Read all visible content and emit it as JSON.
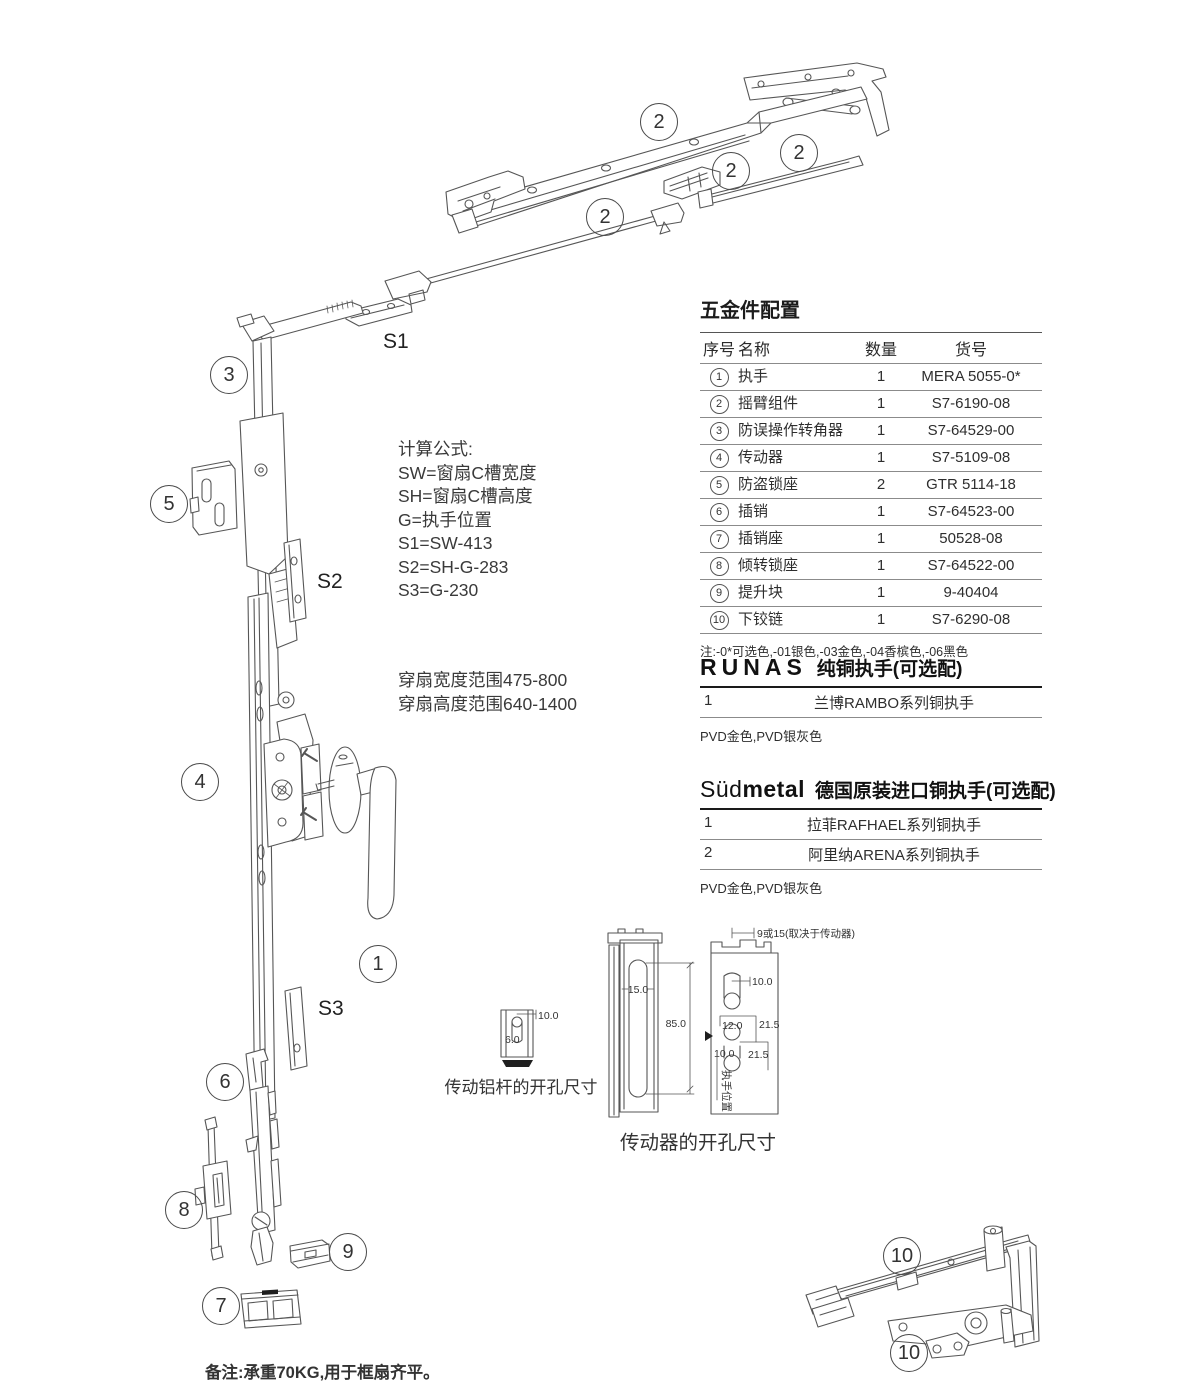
{
  "callouts": [
    {
      "x": 658,
      "y": 121,
      "label": "2"
    },
    {
      "x": 730,
      "y": 170,
      "label": "2"
    },
    {
      "x": 798,
      "y": 152,
      "label": "2"
    },
    {
      "x": 604,
      "y": 216,
      "label": "2"
    },
    {
      "x": 228,
      "y": 374,
      "label": "3"
    },
    {
      "x": 168,
      "y": 503,
      "label": "5"
    },
    {
      "x": 199,
      "y": 781,
      "label": "4"
    },
    {
      "x": 377,
      "y": 963,
      "label": "1"
    },
    {
      "x": 224,
      "y": 1081,
      "label": "6"
    },
    {
      "x": 183,
      "y": 1209,
      "label": "8"
    },
    {
      "x": 347,
      "y": 1251,
      "label": "9"
    },
    {
      "x": 220,
      "y": 1305,
      "label": "7"
    },
    {
      "x": 901,
      "y": 1255,
      "label": "10"
    },
    {
      "x": 908,
      "y": 1352,
      "label": "10"
    }
  ],
  "s_markers": [
    {
      "x": 383,
      "y": 330,
      "label": "S1"
    },
    {
      "x": 317,
      "y": 570,
      "label": "S2"
    },
    {
      "x": 318,
      "y": 997,
      "label": "S3"
    }
  ],
  "formulas": {
    "title": "计算公式:",
    "lines": [
      "SW=窗扇C槽宽度",
      "SH=窗扇C槽高度",
      "G=执手位置",
      "S1=SW-413",
      "S2=SH-G-283",
      "S3=G-230"
    ]
  },
  "ranges": [
    "穿扇宽度范围475-800",
    "穿扇高度范围640-1400"
  ],
  "hardware_table": {
    "title": "五金件配置",
    "headers": [
      "序号",
      "名称",
      "数量",
      "货号"
    ],
    "rows": [
      {
        "no": "1",
        "name": "执手",
        "qty": "1",
        "code": "MERA 5055-0*"
      },
      {
        "no": "2",
        "name": "摇臂组件",
        "qty": "1",
        "code": "S7-6190-08"
      },
      {
        "no": "3",
        "name": "防误操作转角器",
        "qty": "1",
        "code": "S7-64529-00"
      },
      {
        "no": "4",
        "name": "传动器",
        "qty": "1",
        "code": "S7-5109-08"
      },
      {
        "no": "5",
        "name": "防盗锁座",
        "qty": "2",
        "code": "GTR 5114-18"
      },
      {
        "no": "6",
        "name": "插销",
        "qty": "1",
        "code": "S7-64523-00"
      },
      {
        "no": "7",
        "name": "插销座",
        "qty": "1",
        "code": "50528-08"
      },
      {
        "no": "8",
        "name": "倾转锁座",
        "qty": "1",
        "code": "S7-64522-00"
      },
      {
        "no": "9",
        "name": "提升块",
        "qty": "1",
        "code": "9-40404"
      },
      {
        "no": "10",
        "name": "下铰链",
        "qty": "1",
        "code": "S7-6290-08"
      }
    ],
    "note": "注:-0*可选色,-01银色,-03金色,-04香槟色,-06黑色"
  },
  "runas": {
    "brand": "RUNAS",
    "title": "纯铜执手(可选配)",
    "rows": [
      {
        "no": "1",
        "name": "兰博RAMBO系列铜执手"
      }
    ],
    "note": "PVD金色,PVD银灰色"
  },
  "sudmetal": {
    "brand_prefix": "Süd",
    "brand_suffix": "metal",
    "title": "德国原装进口铜执手(可选配)",
    "rows": [
      {
        "no": "1",
        "name": "拉菲RAFHAEL系列铜执手"
      },
      {
        "no": "2",
        "name": "阿里纳ARENA系列铜执手"
      }
    ],
    "note": "PVD金色,PVD银灰色"
  },
  "dims": {
    "rod": {
      "d_top": "10.0",
      "d_inner": "6.0",
      "caption": "传动铝杆的开孔尺寸"
    },
    "driver": {
      "slot": "15.0",
      "height": "85.0",
      "caption": "传动器的开孔尺寸"
    },
    "opening": {
      "top": "9或15(取决于传动器)",
      "hole": "10.0",
      "offset": "12.0",
      "pitch1": "21.5",
      "pitch2": "21.5",
      "hole2": "10.0",
      "side": "执手位置"
    }
  },
  "footer_note": "备注:承重70KG,用于框扇齐平。"
}
